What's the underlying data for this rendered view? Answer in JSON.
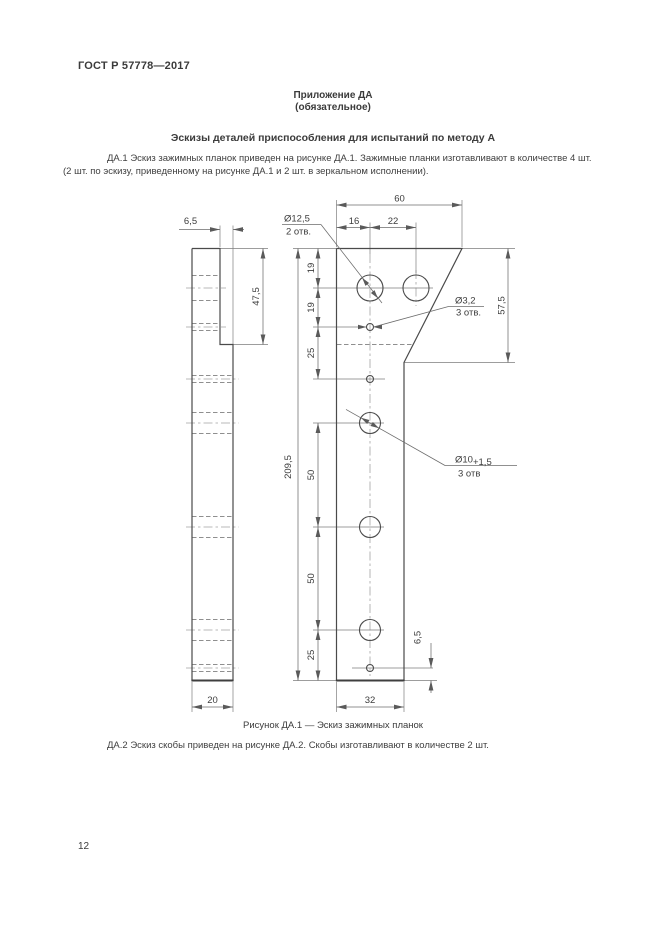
{
  "page": {
    "doc_number": "ГОСТ Р 57778—2017",
    "page_number": "12"
  },
  "appendix": {
    "label": "Приложение ДА",
    "type": "(обязательное)",
    "title": "Эскизы деталей приспособления для испытаний по методу А"
  },
  "paragraphs": {
    "da1_line1": "ДА.1 Эскиз зажимных планок приведен на рисунке ДА.1. Зажимные планки изготавливают в количестве 4 шт.",
    "da1_line2": "(2 шт. по эскизу, приведенному на рисунке ДА.1 и 2 шт. в зеркальном исполнении).",
    "da2": "ДА.2 Эскиз скобы приведен на рисунке ДА.2. Скобы изготавливают в количестве 2 шт."
  },
  "figure": {
    "caption": "Рисунок ДА.1 — Эскиз зажимных планок",
    "dimensions": {
      "top_width": "60",
      "hole_offset_16": "16",
      "hole_spacing_22": "22",
      "step_thickness": "6,5",
      "step_height": "47,5",
      "head_height": "57,5",
      "total_height": "209,5",
      "chain_19a": "19",
      "chain_19b": "19",
      "chain_25a": "25",
      "chain_50a": "50",
      "chain_50b": "50",
      "chain_25b": "25",
      "bottom_hole_offset": "6,5",
      "bottom_width": "32",
      "side_width": "20"
    },
    "callouts": {
      "d125": "Ø12,5",
      "d125_qty": "2 отв.",
      "d32": "Ø3,2",
      "d32_qty": "3 отв.",
      "d10": "Ø10",
      "d10_tol": "+1,5",
      "d10_qty": "3 отв"
    }
  }
}
